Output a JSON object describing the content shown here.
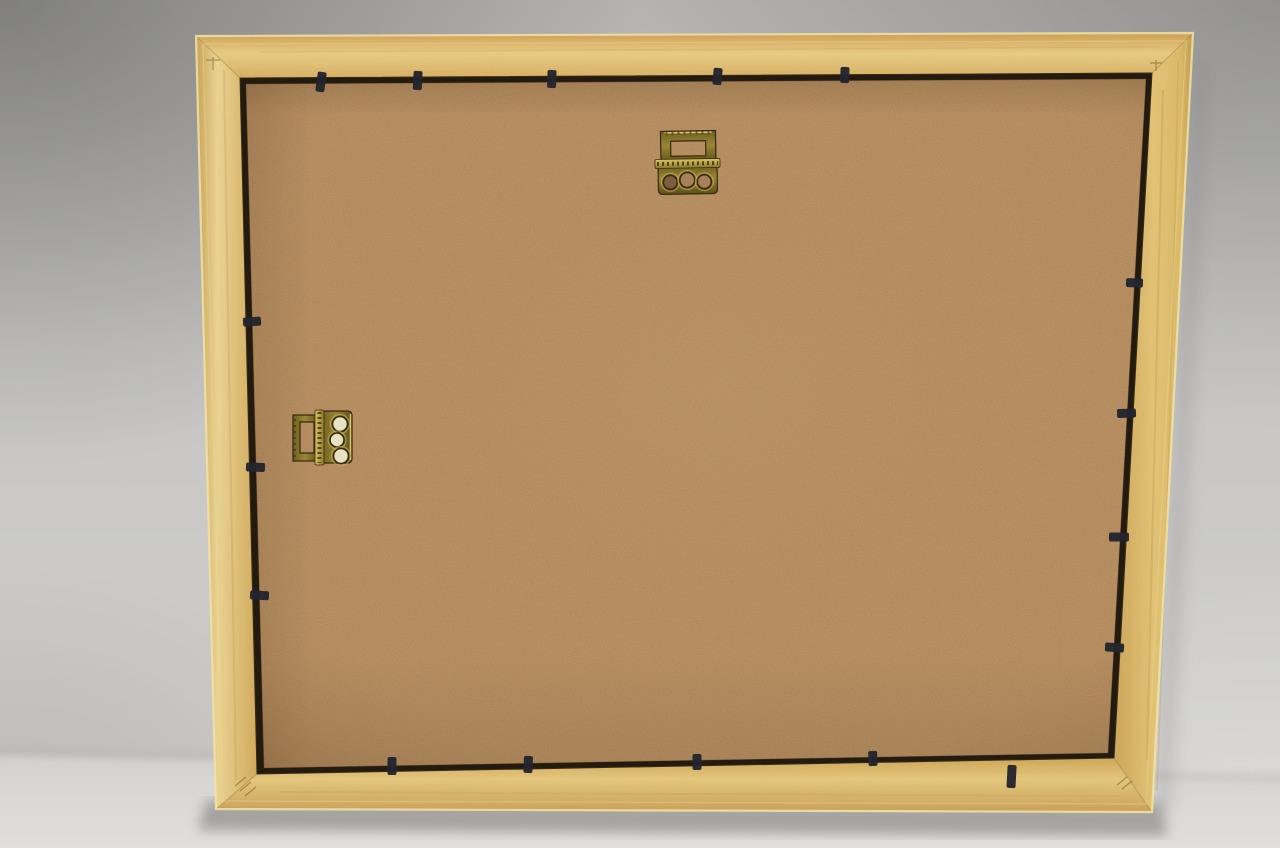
{
  "scene": {
    "description": "Photograph of the back of a light beech wooden picture frame leaning against a grey wall on a pale table. The back shows a tan MDF backing board held by small black retaining tabs around the rebate, one brass sawtooth hanger at the top centre and one brass sawtooth hanger on the left side for portrait hanging.",
    "width": 1280,
    "height": 848
  },
  "palette": {
    "wall": "#c6c5c3",
    "table": "#dcdbd8",
    "frame_wood": "#ddbc72",
    "wood_highlight": "#f1e3a6",
    "wood_highlight2": "#ecd88e",
    "frame_base": "#d9b768",
    "rebate": "#241b10",
    "rebate_stroke": "#3a2c18",
    "mdf": "#b68c5e",
    "mdf_edge_stroke": "#5a4020",
    "tab": "#23242e",
    "brass_outline": "#352a0e",
    "brass_rim": "#c8b254",
    "brass_tick": "#3a3010",
    "brass_highlight": "#e6d87e",
    "hole_mdf": "#a8805a",
    "hole_mdf_dark": "#7e5e40",
    "hole_light": "#e9e2c2",
    "shadow_under": "#6f6d69",
    "shadow_side": "#848280",
    "shadow_line": "#a8a6a3",
    "miter": "#8a6a34",
    "corner_mark": "#6e5224",
    "streak": "#b8924a",
    "grain_fill": "#caa258"
  },
  "frame": {
    "outer": [
      [
        196,
        36
      ],
      [
        1193,
        33
      ],
      [
        1152,
        812
      ],
      [
        216,
        809
      ]
    ],
    "inner": [
      [
        240,
        78
      ],
      [
        1152,
        73
      ],
      [
        1114,
        758
      ],
      [
        257,
        774
      ]
    ],
    "board": [
      [
        246,
        84
      ],
      [
        1146,
        79
      ],
      [
        1108,
        753
      ],
      [
        264,
        768
      ]
    ],
    "inner_highlight": [
      [
        203,
        44
      ],
      [
        1186,
        41
      ],
      [
        1146,
        804
      ],
      [
        223,
        801
      ]
    ]
  },
  "gradients": [
    {
      "id": "gWall",
      "type": "linear",
      "x1": 0,
      "y1": 0,
      "x2": 0,
      "y2": 1,
      "stops": [
        [
          0,
          "#b4b3b1"
        ],
        [
          0.4,
          "#c7c6c4"
        ],
        [
          1,
          "#d0cfcc"
        ]
      ]
    },
    {
      "id": "gTable",
      "type": "linear",
      "x1": 0,
      "y1": 0,
      "x2": 0,
      "y2": 1,
      "stops": [
        [
          0,
          "#d2d1ce"
        ],
        [
          1,
          "#e4e3e0"
        ]
      ]
    },
    {
      "id": "gWoodTop",
      "type": "linear",
      "x1": 0,
      "y1": 0,
      "x2": 0,
      "y2": 1,
      "stops": [
        [
          0,
          "#cf9f55"
        ],
        [
          0.45,
          "#e9cd86"
        ],
        [
          1,
          "#d8b164"
        ]
      ]
    },
    {
      "id": "gWoodRight",
      "type": "linear",
      "x1": 0,
      "y1": 0,
      "x2": 1,
      "y2": 0,
      "stops": [
        [
          0,
          "#cda65a"
        ],
        [
          0.5,
          "#e4c476"
        ],
        [
          0.85,
          "#dcba6a"
        ],
        [
          1,
          "#bf9a4e"
        ]
      ]
    },
    {
      "id": "gWoodBottom",
      "type": "linear",
      "x1": 0,
      "y1": 0,
      "x2": 0,
      "y2": 1,
      "stops": [
        [
          0,
          "#cfa758"
        ],
        [
          0.4,
          "#e6c87e"
        ],
        [
          1,
          "#caa058"
        ]
      ]
    },
    {
      "id": "gWoodLeft",
      "type": "linear",
      "x1": 0,
      "y1": 0,
      "x2": 1,
      "y2": 0,
      "stops": [
        [
          0,
          "#c9a458"
        ],
        [
          0.35,
          "#ecd594"
        ],
        [
          1,
          "#d2ab5c"
        ]
      ]
    },
    {
      "id": "gBrass",
      "type": "linear",
      "x1": 0,
      "y1": 0,
      "x2": 0,
      "y2": 1,
      "stops": [
        [
          0,
          "#6e5f22"
        ],
        [
          0.45,
          "#9a8634"
        ],
        [
          1,
          "#5c4e1a"
        ]
      ]
    },
    {
      "id": "gBrassBar",
      "type": "linear",
      "x1": 0,
      "y1": 0,
      "x2": 0,
      "y2": 1,
      "stops": [
        [
          0,
          "#d8c462"
        ],
        [
          0.5,
          "#b5a044"
        ],
        [
          1,
          "#8a762c"
        ]
      ]
    },
    {
      "id": "gBrassV",
      "type": "linear",
      "x1": 0,
      "y1": 0,
      "x2": 1,
      "y2": 0,
      "stops": [
        [
          0,
          "#6e5f22"
        ],
        [
          0.45,
          "#9a8634"
        ],
        [
          1,
          "#5c4e1a"
        ]
      ]
    },
    {
      "id": "gBrassBarV",
      "type": "linear",
      "x1": 0,
      "y1": 0,
      "x2": 1,
      "y2": 0,
      "stops": [
        [
          0,
          "#d8c462"
        ],
        [
          0.5,
          "#b5a044"
        ],
        [
          1,
          "#8a762c"
        ]
      ]
    },
    {
      "id": "gMdfShade",
      "type": "radial",
      "cx": 0.52,
      "cy": 0.45,
      "r": 0.78,
      "stops": [
        [
          0,
          "rgba(205,170,120,0.10)"
        ],
        [
          0.7,
          "rgba(150,110,65,0.03)"
        ],
        [
          1,
          "rgba(80,52,26,0.20)"
        ]
      ]
    },
    {
      "id": "gVinTL",
      "type": "radial",
      "cx": 0,
      "cy": 0,
      "r": 1,
      "stops": [
        [
          0,
          "rgba(55,55,53,0.42)"
        ],
        [
          1,
          "rgba(55,55,53,0)"
        ]
      ]
    },
    {
      "id": "gVinTR",
      "type": "radial",
      "cx": 1,
      "cy": 0,
      "r": 1,
      "stops": [
        [
          0,
          "rgba(70,70,68,0.30)"
        ],
        [
          1,
          "rgba(70,70,68,0)"
        ]
      ]
    },
    {
      "id": "gVinBL",
      "type": "radial",
      "cx": 0,
      "cy": 1,
      "r": 1,
      "stops": [
        [
          0,
          "rgba(95,93,89,0.20)"
        ],
        [
          1,
          "rgba(95,93,89,0)"
        ]
      ]
    },
    {
      "id": "gVinBR",
      "type": "radial",
      "cx": 1,
      "cy": 1,
      "r": 1,
      "stops": [
        [
          0,
          "rgba(255,255,255,0.28)"
        ],
        [
          1,
          "rgba(255,255,255,0)"
        ]
      ]
    },
    {
      "id": "gBoardTop",
      "type": "linear",
      "x1": 0,
      "y1": 0,
      "x2": 0,
      "y2": 1,
      "stops": [
        [
          0,
          "rgba(70,45,22,0.20)"
        ],
        [
          1,
          "rgba(70,45,22,0)"
        ]
      ]
    },
    {
      "id": "gBoardLeft",
      "type": "linear",
      "x1": 0,
      "y1": 0,
      "x2": 1,
      "y2": 0,
      "stops": [
        [
          0,
          "rgba(70,45,22,0.14)"
        ],
        [
          1,
          "rgba(70,45,22,0)"
        ]
      ]
    },
    {
      "id": "gBoardBottom",
      "type": "linear",
      "x1": 0,
      "y1": 0,
      "x2": 0,
      "y2": 1,
      "stops": [
        [
          0,
          "rgba(70,45,22,0)"
        ],
        [
          1,
          "rgba(70,45,22,0.12)"
        ]
      ]
    }
  ],
  "background": {
    "table_poly": [
      [
        -20,
        754
      ],
      [
        1300,
        781
      ],
      [
        1300,
        870
      ],
      [
        -20,
        870
      ]
    ],
    "table_line_poly": [
      [
        -10,
        749
      ],
      [
        1290,
        775
      ],
      [
        1290,
        781
      ],
      [
        -10,
        755
      ]
    ],
    "under_shadow_poly": [
      [
        206,
        800
      ],
      [
        1160,
        803
      ],
      [
        1168,
        836
      ],
      [
        198,
        830
      ]
    ],
    "side_shadow_poly": [
      [
        1195,
        60
      ],
      [
        1210,
        64
      ],
      [
        1170,
        815
      ],
      [
        1154,
        810
      ]
    ],
    "vignettes": [
      {
        "x": 0,
        "y": 0,
        "w": 640,
        "h": 470,
        "fill": "gVinTL"
      },
      {
        "x": 640,
        "y": 0,
        "w": 640,
        "h": 430,
        "fill": "gVinTR"
      },
      {
        "x": 0,
        "y": 560,
        "w": 430,
        "h": 288,
        "fill": "gVinBL"
      },
      {
        "x": 680,
        "y": 540,
        "w": 600,
        "h": 308,
        "fill": "gVinBR"
      }
    ]
  },
  "tabs": [
    {
      "x": 322,
      "y": 75,
      "dir": "down",
      "len": 17,
      "tilt": 8
    },
    {
      "x": 418,
      "y": 74,
      "dir": "down",
      "len": 16,
      "tilt": 3
    },
    {
      "x": 552,
      "y": 73,
      "dir": "down",
      "len": 15,
      "tilt": 2
    },
    {
      "x": 718,
      "y": 71,
      "dir": "down",
      "len": 14,
      "tilt": 5
    },
    {
      "x": 845,
      "y": 70,
      "dir": "down",
      "len": 13,
      "tilt": 2
    },
    {
      "x": 246,
      "y": 322,
      "dir": "right",
      "len": 15,
      "tilt": -4
    },
    {
      "x": 249,
      "y": 467,
      "dir": "right",
      "len": 16,
      "tilt": 2
    },
    {
      "x": 253,
      "y": 595,
      "dir": "right",
      "len": 16,
      "tilt": 3
    },
    {
      "x": 1140,
      "y": 283,
      "dir": "left",
      "len": 14,
      "tilt": 2
    },
    {
      "x": 1133,
      "y": 413,
      "dir": "left",
      "len": 16,
      "tilt": -2
    },
    {
      "x": 1126,
      "y": 537,
      "dir": "left",
      "len": 17,
      "tilt": 0
    },
    {
      "x": 1121,
      "y": 648,
      "dir": "left",
      "len": 16,
      "tilt": 4
    },
    {
      "x": 392,
      "y": 772,
      "dir": "up",
      "len": 15,
      "tilt": 0
    },
    {
      "x": 528,
      "y": 770,
      "dir": "up",
      "len": 14,
      "tilt": 2
    },
    {
      "x": 697,
      "y": 767,
      "dir": "up",
      "len": 13,
      "tilt": 0
    },
    {
      "x": 873,
      "y": 763,
      "dir": "up",
      "len": 12,
      "tilt": -2
    },
    {
      "x": 1012,
      "y": 768,
      "dir": "down",
      "len": 20,
      "tilt": 3
    }
  ],
  "hanger_top": {
    "rot": -1,
    "cx": 687,
    "cy": 163,
    "loop": {
      "x": 661,
      "y": 131,
      "w": 55,
      "h": 32,
      "ix": 671,
      "iy": 141,
      "iw": 35,
      "ih": 15
    },
    "bar": {
      "x": 655,
      "y": 159,
      "w": 65,
      "h": 9
    },
    "plate": {
      "x": 658,
      "y": 166,
      "w": 59,
      "h": 28
    },
    "holes": [
      {
        "cx": 670,
        "cy": 182,
        "r": 7,
        "fill": "hole_mdf_dark"
      },
      {
        "cx": 687,
        "cy": 180,
        "r": 7.5,
        "fill": "hole_mdf"
      },
      {
        "cx": 704,
        "cy": 182,
        "r": 7,
        "fill": "hole_mdf"
      }
    ]
  },
  "hanger_left": {
    "rot": 0,
    "cx": 322,
    "cy": 438,
    "loop": {
      "x": 293,
      "y": 415,
      "w": 27,
      "h": 46,
      "ix": 300,
      "iy": 422,
      "iw": 14,
      "ih": 31
    },
    "bar": {
      "x": 315,
      "y": 410,
      "w": 9,
      "h": 55
    },
    "plate": {
      "x": 322,
      "y": 411,
      "w": 30,
      "h": 52
    },
    "holes": [
      {
        "cx": 340,
        "cy": 424,
        "r": 7.5,
        "fill": "hole_light"
      },
      {
        "cx": 337,
        "cy": 440,
        "r": 7,
        "fill": "hole_light"
      },
      {
        "cx": 341,
        "cy": 456,
        "r": 7.5,
        "fill": "hole_light"
      }
    ]
  },
  "wood_streaks": [
    {
      "d": "M1163,90 C1160,280 1154,520 1147,760",
      "w": 2,
      "o": 0.3
    },
    {
      "d": "M1178,60 C1174,300 1166,560 1157,790",
      "w": 1.5,
      "o": 0.25
    },
    {
      "d": "M224,70 C228,300 232,560 236,780",
      "w": 2,
      "o": 0.25
    },
    {
      "d": "M260,52 L1160,47",
      "w": 1.5,
      "o": 0.2
    },
    {
      "d": "M280,792 L1120,796",
      "w": 2,
      "o": 0.2
    }
  ],
  "corner_marks": [
    "M206,60 h14 M213,57 v13",
    "M1150,63 h12 M1156,60 v11",
    "M235,786 l11,-9 M240,791 l11,-9 M245,796 l11,-9",
    "M1117,785 l10,-8 M1122,789 l10,-8"
  ]
}
